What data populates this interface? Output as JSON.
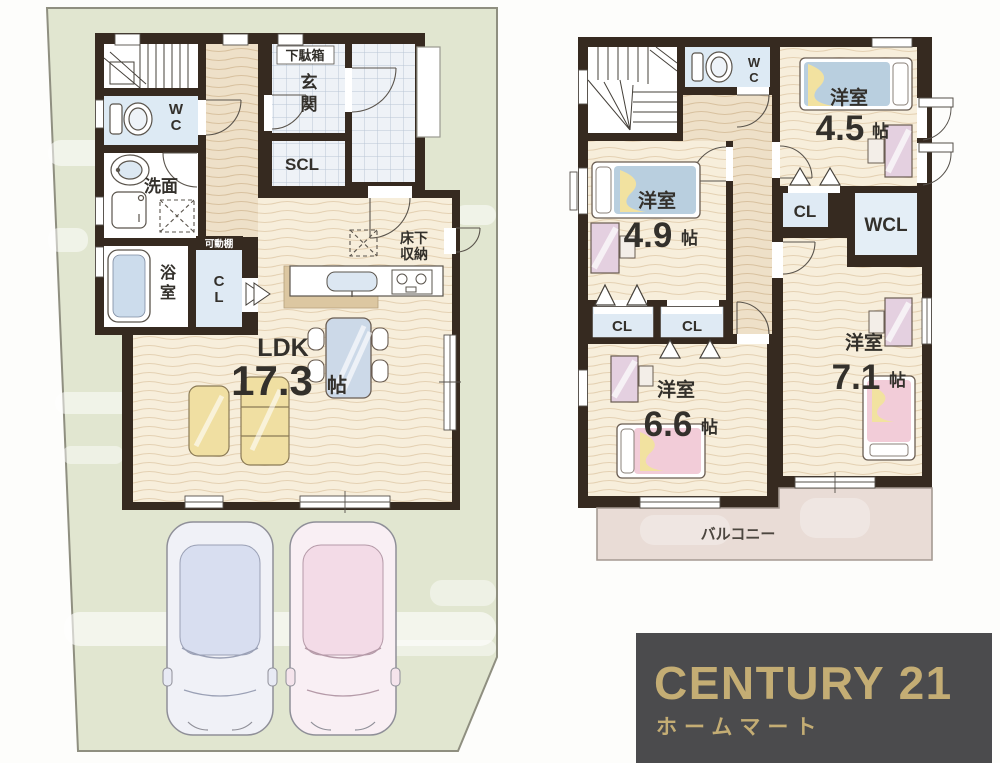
{
  "floor1": {
    "ldk": {
      "label": "LDK",
      "size": "17.3",
      "unit": "帖"
    },
    "entrance": [
      "玄",
      "関"
    ],
    "scl": "SCL",
    "shoe_box": "下駄箱",
    "wc": [
      "W",
      "C"
    ],
    "washroom": "洗面",
    "bath": [
      "浴",
      "室"
    ],
    "cl": [
      "C",
      "L"
    ],
    "movable_shelf": "可動棚",
    "underfloor": [
      "床下",
      "収納"
    ]
  },
  "floor2": {
    "wc": [
      "W",
      "C"
    ],
    "rooms": {
      "r45": {
        "label": "洋室",
        "size": "4.5",
        "unit": "帖"
      },
      "r49": {
        "label": "洋室",
        "size": "4.9",
        "unit": "帖"
      },
      "r66": {
        "label": "洋室",
        "size": "6.6",
        "unit": "帖"
      },
      "r71": {
        "label": "洋室",
        "size": "7.1",
        "unit": "帖"
      }
    },
    "cl_mid": "CL",
    "wcl": "WCL",
    "cl_a": "CL",
    "cl_b": "CL",
    "balcony": "バルコニー"
  },
  "logo": {
    "brand": "CENTURY 21",
    "store": "ホームマート"
  },
  "colors": {
    "site_green": "#e1e6d0",
    "wall": "#362a20",
    "logo_bg": "#4b4b4d",
    "logo_gold": "#c4ad74",
    "floor_cream": "#f7eedb",
    "hall_tan": "#eee0c8",
    "tile_blue": "#eef2f7",
    "closet_blue": "#dfeaf4",
    "balcony_pink": "#e9dcd6"
  }
}
